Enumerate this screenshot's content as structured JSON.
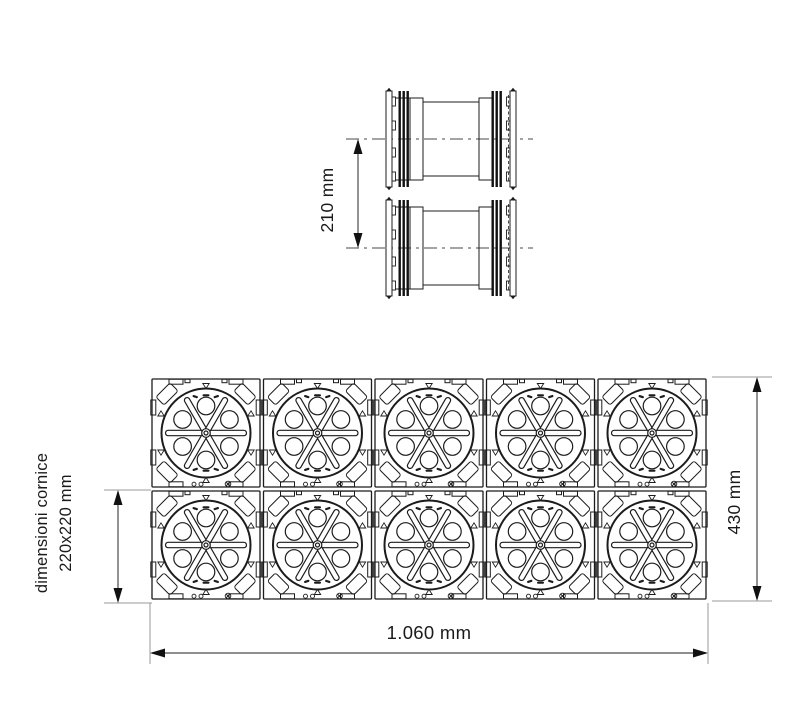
{
  "meta": {
    "drawing_type": "technical dimension drawing",
    "views": [
      "coupler side view (top)",
      "module grid plan view (bottom)"
    ],
    "background": "#ffffff"
  },
  "colors": {
    "line": "#1c1c1c",
    "dim_line": "#4a4a4a",
    "ext_line": "#9a9a9a",
    "text": "#1a1a1a",
    "fill": "#ffffff"
  },
  "top_view": {
    "description": "two stacked duct couplers, side view with centerlines",
    "units": 2,
    "dimension": {
      "label": "210 mm"
    }
  },
  "grid_view": {
    "description": "grid of interlocking square duct modules",
    "rows": 2,
    "cols": 5,
    "caption_line1": "dimensioni cornice",
    "caption_line2": "220x220 mm",
    "height_dimension": "430 mm",
    "width_dimension": "1.060 mm"
  }
}
